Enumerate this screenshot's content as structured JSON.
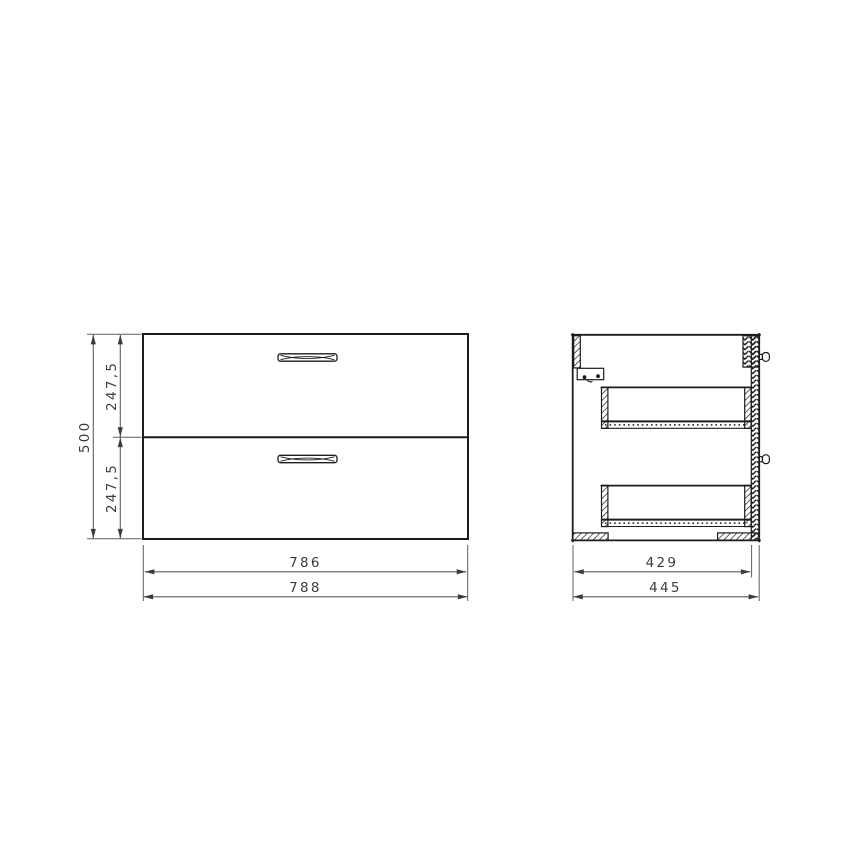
{
  "drawing": {
    "colors": {
      "bg": "#ffffff",
      "object_line": "#1c1c1c",
      "dim_line": "#5f5f5f",
      "text_color": "#3c3c3c"
    },
    "front_view": {
      "dim_total_height": "500",
      "dim_upper_drawer_height": "247,5",
      "dim_lower_drawer_height": "247,5",
      "dim_drawer_front_width": "786",
      "dim_total_width": "788"
    },
    "side_view": {
      "dim_inner_depth": "429",
      "dim_total_depth": "445"
    }
  }
}
